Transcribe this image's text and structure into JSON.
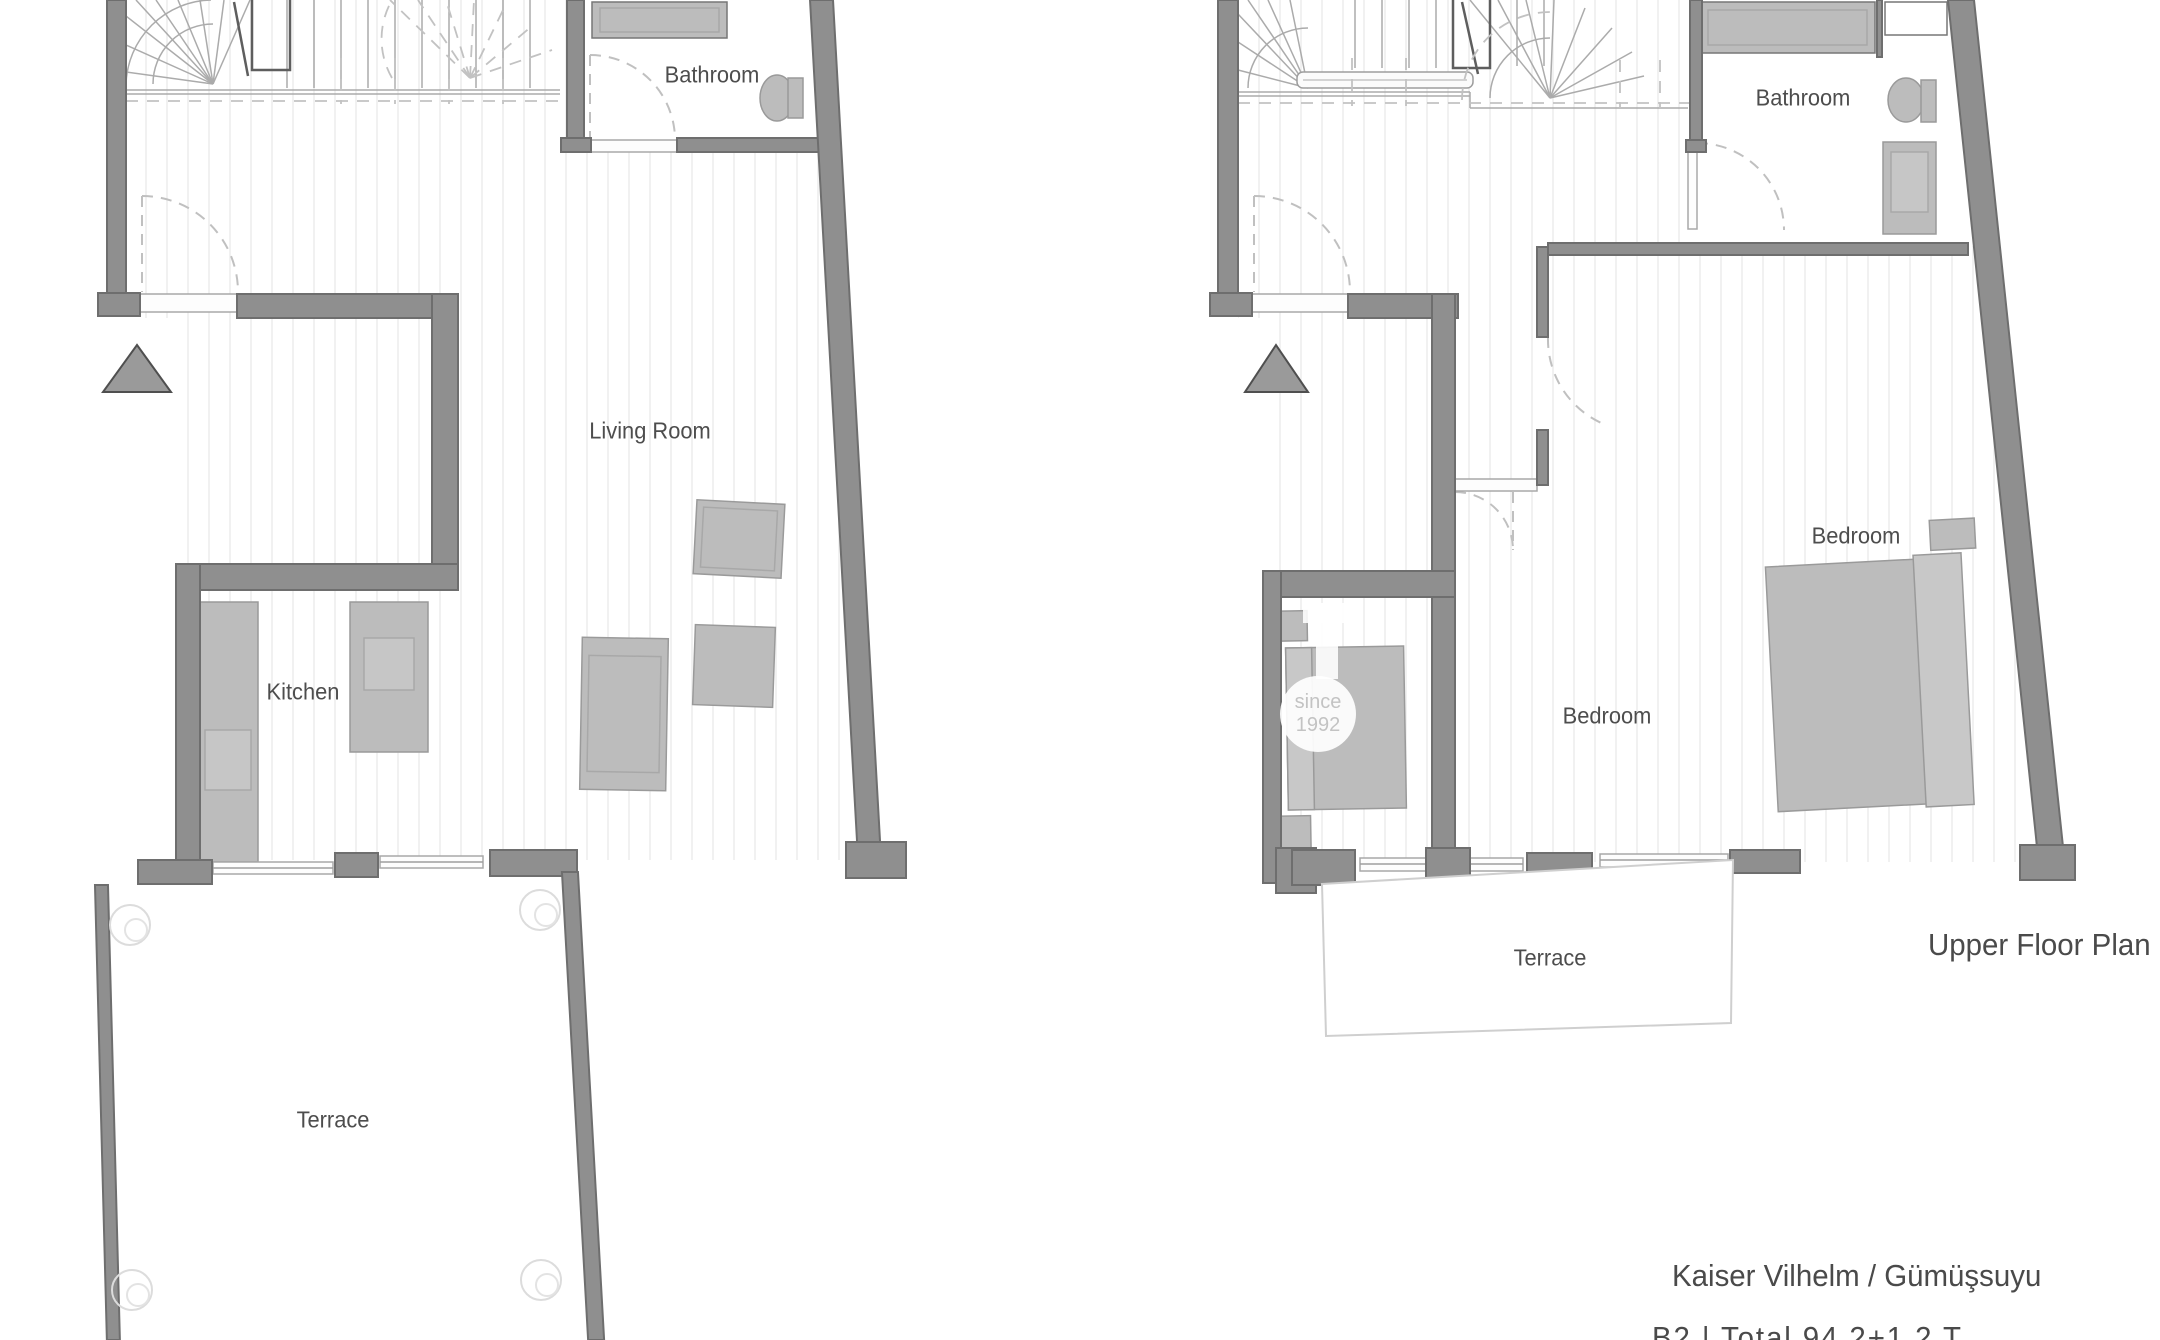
{
  "title_block": {
    "project_name": "Kaiser Vilhelm / Gümüşsuyu",
    "plan_caption": "Upper Floor Plan",
    "details_line_partial": "B2 | Total 94   2+1   2 T"
  },
  "watermark": {
    "badge_line1": "since",
    "badge_line2": "1992"
  },
  "lower_plan": {
    "rooms": {
      "bathroom": "Bathroom",
      "living_room": "Living Room",
      "kitchen": "Kitchen",
      "terrace": "Terrace"
    }
  },
  "upper_plan": {
    "rooms": {
      "bathroom": "Bathroom",
      "bedroom_left": "Bedroom",
      "bedroom_right": "Bedroom",
      "terrace": "Terrace"
    }
  },
  "colors": {
    "wall": "#8f8f8f",
    "wall_border": "#6e6e6e",
    "furniture": "#bcbcbc",
    "furniture_border": "#9a9a9a",
    "floor_stripe": "#f1f1f1",
    "dashed_line": "#c0c0c0",
    "text": "#4d4d4d"
  }
}
